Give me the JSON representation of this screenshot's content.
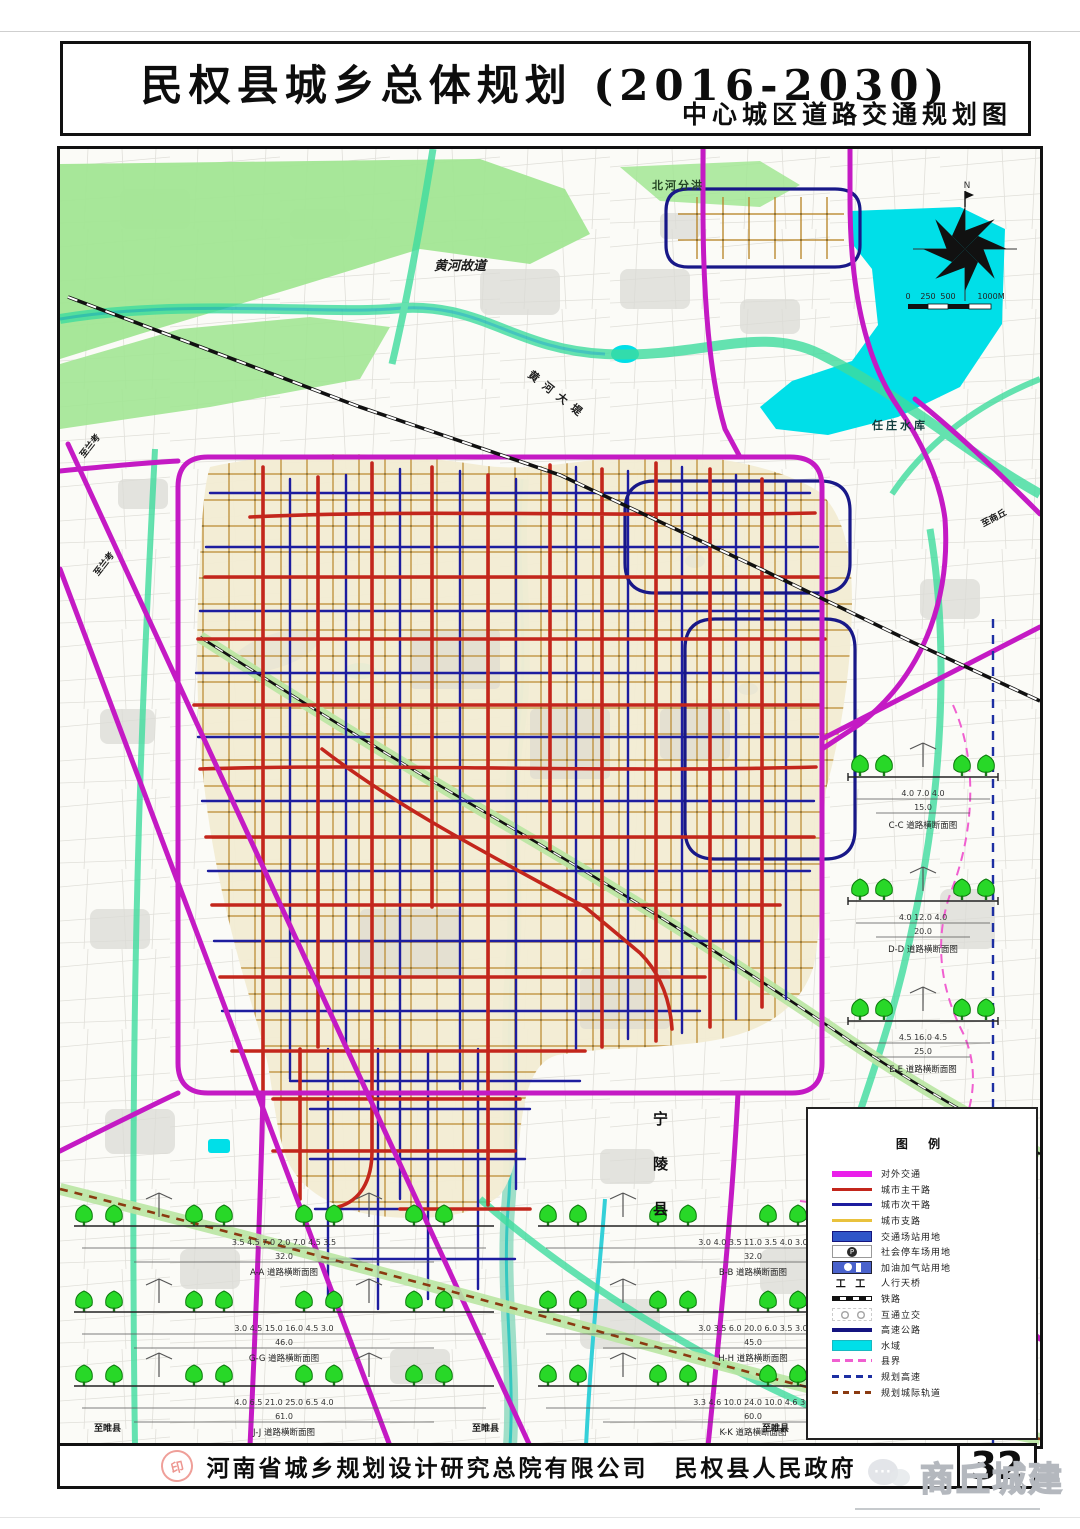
{
  "title": {
    "main": "民权县城乡总体规划",
    "year": "(2016-2030)",
    "subtitle": "中心城区道路交通规划图"
  },
  "compass": {
    "north_label": "N"
  },
  "scale_bar": {
    "t0": "0",
    "t1": "250",
    "t2": "500",
    "t3": "1000M"
  },
  "map_labels": {
    "old_yellow_river": "黄河故道",
    "yellow_river_dike": "黄河大堤",
    "renzhuang_reservoir": "任庄水库",
    "north_river_area": "北河分洪",
    "ningling_county": "宁陵县",
    "to_lankao": "至兰考",
    "to_suixian": "至睢县",
    "to_shangqiu": "至商丘"
  },
  "legend": {
    "title": "图 例",
    "items": [
      {
        "label": "对外交通"
      },
      {
        "label": "城市主干路"
      },
      {
        "label": "城市次干路"
      },
      {
        "label": "城市支路"
      },
      {
        "label": "交通场站用地"
      },
      {
        "label": "社会停车场用地"
      },
      {
        "label": "加油加气站用地"
      },
      {
        "label": "人行天桥"
      },
      {
        "label": "铁路"
      },
      {
        "label": "互通立交"
      },
      {
        "label": "高速公路"
      },
      {
        "label": "水域"
      },
      {
        "label": "县界"
      },
      {
        "label": "规划高速"
      },
      {
        "label": "规划城际轨道"
      }
    ]
  },
  "cross_sections": {
    "right": [
      {
        "name": "C-C 道路横断面图",
        "dims": "4.0   7.0   4.0",
        "total": "15.0"
      },
      {
        "name": "D-D 道路横断面图",
        "dims": "4.0   12.0   4.0",
        "total": "20.0"
      },
      {
        "name": "E-E 道路横断面图",
        "dims": "4.5   16.0   4.5",
        "total": "25.0"
      },
      {
        "name": "F-F 道路横断面图",
        "dims": "7.0   24.0   7.0",
        "total": "38.0"
      }
    ],
    "bottom": [
      {
        "name": "A-A 道路横断面图",
        "dims": "3.5  4.5  7.0  2.0  7.0  4.5  3.5",
        "total": "32.0"
      },
      {
        "name": "B-B 道路横断面图",
        "dims": "3.0  4.0  3.5  11.0  3.5  4.0  3.0",
        "total": "32.0"
      },
      {
        "name": "G-G 道路横断面图",
        "dims": "3.0  4.5  15.0  16.0  4.5  3.0",
        "total": "46.0"
      },
      {
        "name": "H-H 道路横断面图",
        "dims": "3.0  3.5  6.0  20.0  6.0  3.5  3.0",
        "total": "45.0"
      },
      {
        "name": "J-J 道路横断面图",
        "dims": "4.0  6.5  21.0  25.0  6.5  4.0",
        "total": "61.0"
      },
      {
        "name": "K-K 道路横断面图",
        "dims": "3.3  4.6  10.0  24.0  10.0  4.6  3.3",
        "total": "60.0"
      }
    ]
  },
  "footer": {
    "company": "河南省城乡规划设计研究总院有限公司",
    "government": "民权县人民政府",
    "page_number": "32",
    "seal_char": "印"
  },
  "watermark": {
    "text": "商丘城建",
    "dots": "···"
  },
  "colors": {
    "external_traffic": "#c41ac4",
    "arterial_road": "#c3261c",
    "secondary_road": "#1d1d9f",
    "branch_road": "#b8862a",
    "water": "#00dfe8",
    "greenway": "#3fdc9e",
    "urban_fill": "#f2ecd3",
    "county_boundary": "#f05fd0",
    "railway": "#111111"
  }
}
